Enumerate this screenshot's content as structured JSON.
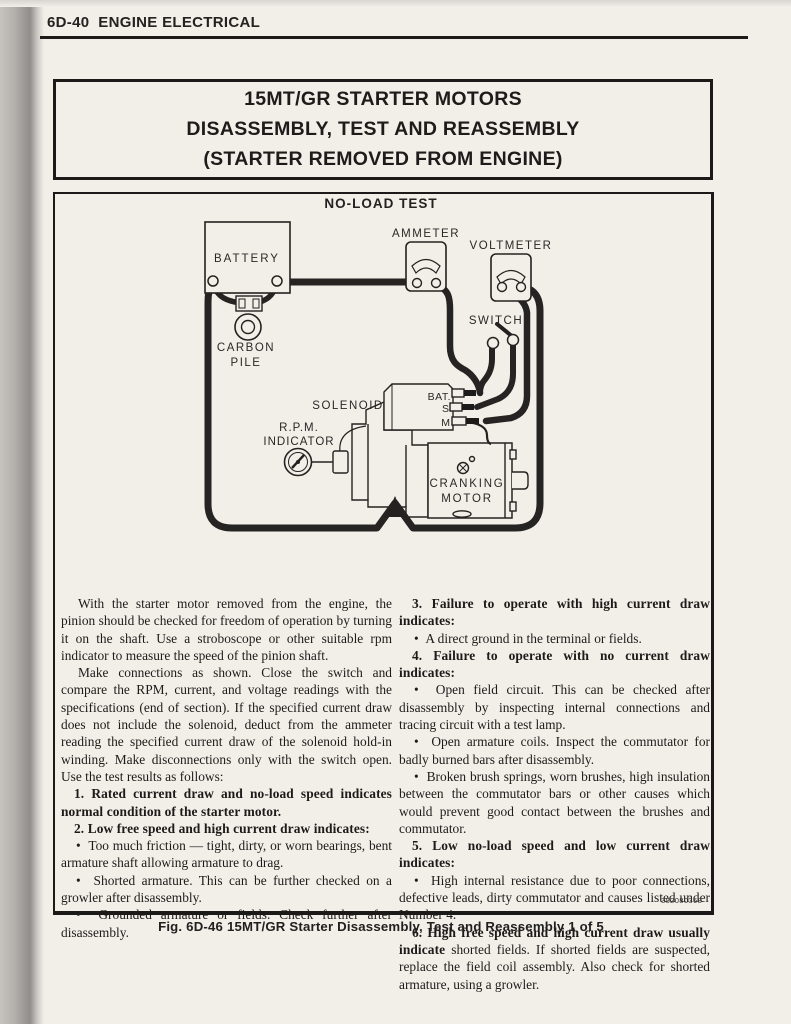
{
  "page": {
    "header": "6D-40  ENGINE ELECTRICAL",
    "part_number": "382080368",
    "caption": "Fig. 6D-46 15MT/GR Starter Disassembly, Test and Reassembly 1 of 5"
  },
  "title_box": {
    "lines": [
      "15MT/GR STARTER MOTORS",
      "DISASSEMBLY, TEST AND REASSEMBLY",
      "(STARTER REMOVED FROM ENGINE)"
    ]
  },
  "diagram": {
    "title": "NO-LOAD TEST",
    "labels": {
      "battery": "BATTERY",
      "carbon_pile_1": "CARBON",
      "carbon_pile_2": "PILE",
      "ammeter": "AMMETER",
      "voltmeter": "VOLTMETER",
      "switch": "SWITCH",
      "solenoid": "SOLENOID",
      "rpm_1": "R.P.M.",
      "rpm_2": "INDICATOR",
      "terminal_bat": "BAT.",
      "terminal_s": "S",
      "terminal_m": "M",
      "motor_1": "CRANKING",
      "motor_2": "MOTOR"
    }
  },
  "article": {
    "bullet_char": "•",
    "left_column": [
      {
        "type": "paragraph",
        "text": "With the starter motor removed from the engine, the pinion should be checked for freedom of operation by turning it on the shaft. Use a stroboscope or other suitable rpm indicator to measure the speed of the pinion shaft."
      },
      {
        "type": "paragraph",
        "text": "Make connections as shown. Close the switch and compare the RPM, current, and voltage readings with the specifications (end of section). If the specified current draw does not include the solenoid, deduct from the ammeter reading the specified current draw of the solenoid hold-in winding. Make disconnections only with the switch open. Use the test results as follows:"
      },
      {
        "type": "numbered",
        "bold": "1. Rated current draw and no-load speed indicates normal condition of the starter motor.",
        "rest": ""
      },
      {
        "type": "numbered",
        "bold": "2. Low free speed and high current draw indicates:",
        "rest": ""
      },
      {
        "type": "bullet",
        "text": "Too much friction — tight, dirty, or worn bearings, bent armature shaft allowing armature to drag."
      },
      {
        "type": "bullet",
        "text": "Shorted armature. This can be further checked on a growler after disassembly."
      },
      {
        "type": "bullet",
        "text": "Grounded armature or fields. Check further after disassembly."
      }
    ],
    "right_column": [
      {
        "type": "numbered",
        "bold": "3. Failure to operate with high current draw indicates:",
        "rest": ""
      },
      {
        "type": "bullet",
        "text": "A direct ground in the terminal or fields."
      },
      {
        "type": "numbered",
        "bold": "4. Failure to operate with no current draw indicates:",
        "rest": ""
      },
      {
        "type": "bullet",
        "text": "Open field circuit. This can be checked after disassembly by inspecting internal connections and tracing circuit with a test lamp."
      },
      {
        "type": "bullet",
        "text": "Open armature coils. Inspect the commutator for badly burned bars after disassembly."
      },
      {
        "type": "bullet",
        "text": "Broken brush springs, worn brushes, high insulation between the commutator bars or other causes which would prevent good contact between the brushes and commutator."
      },
      {
        "type": "numbered",
        "bold": "5. Low no-load speed and low current draw indicates:",
        "rest": ""
      },
      {
        "type": "bullet",
        "text": "High internal resistance due to poor connections, defective leads, dirty commutator and causes listed under Number 4."
      },
      {
        "type": "numbered",
        "bold": "6. High free speed and high current draw usually indicate",
        "rest": " shorted fields. If shorted fields are suspected, replace the field coil assembly. Also check for shorted armature, using a growler."
      }
    ]
  },
  "colors": {
    "ink": "#242220",
    "paper": "#f2efe9"
  }
}
